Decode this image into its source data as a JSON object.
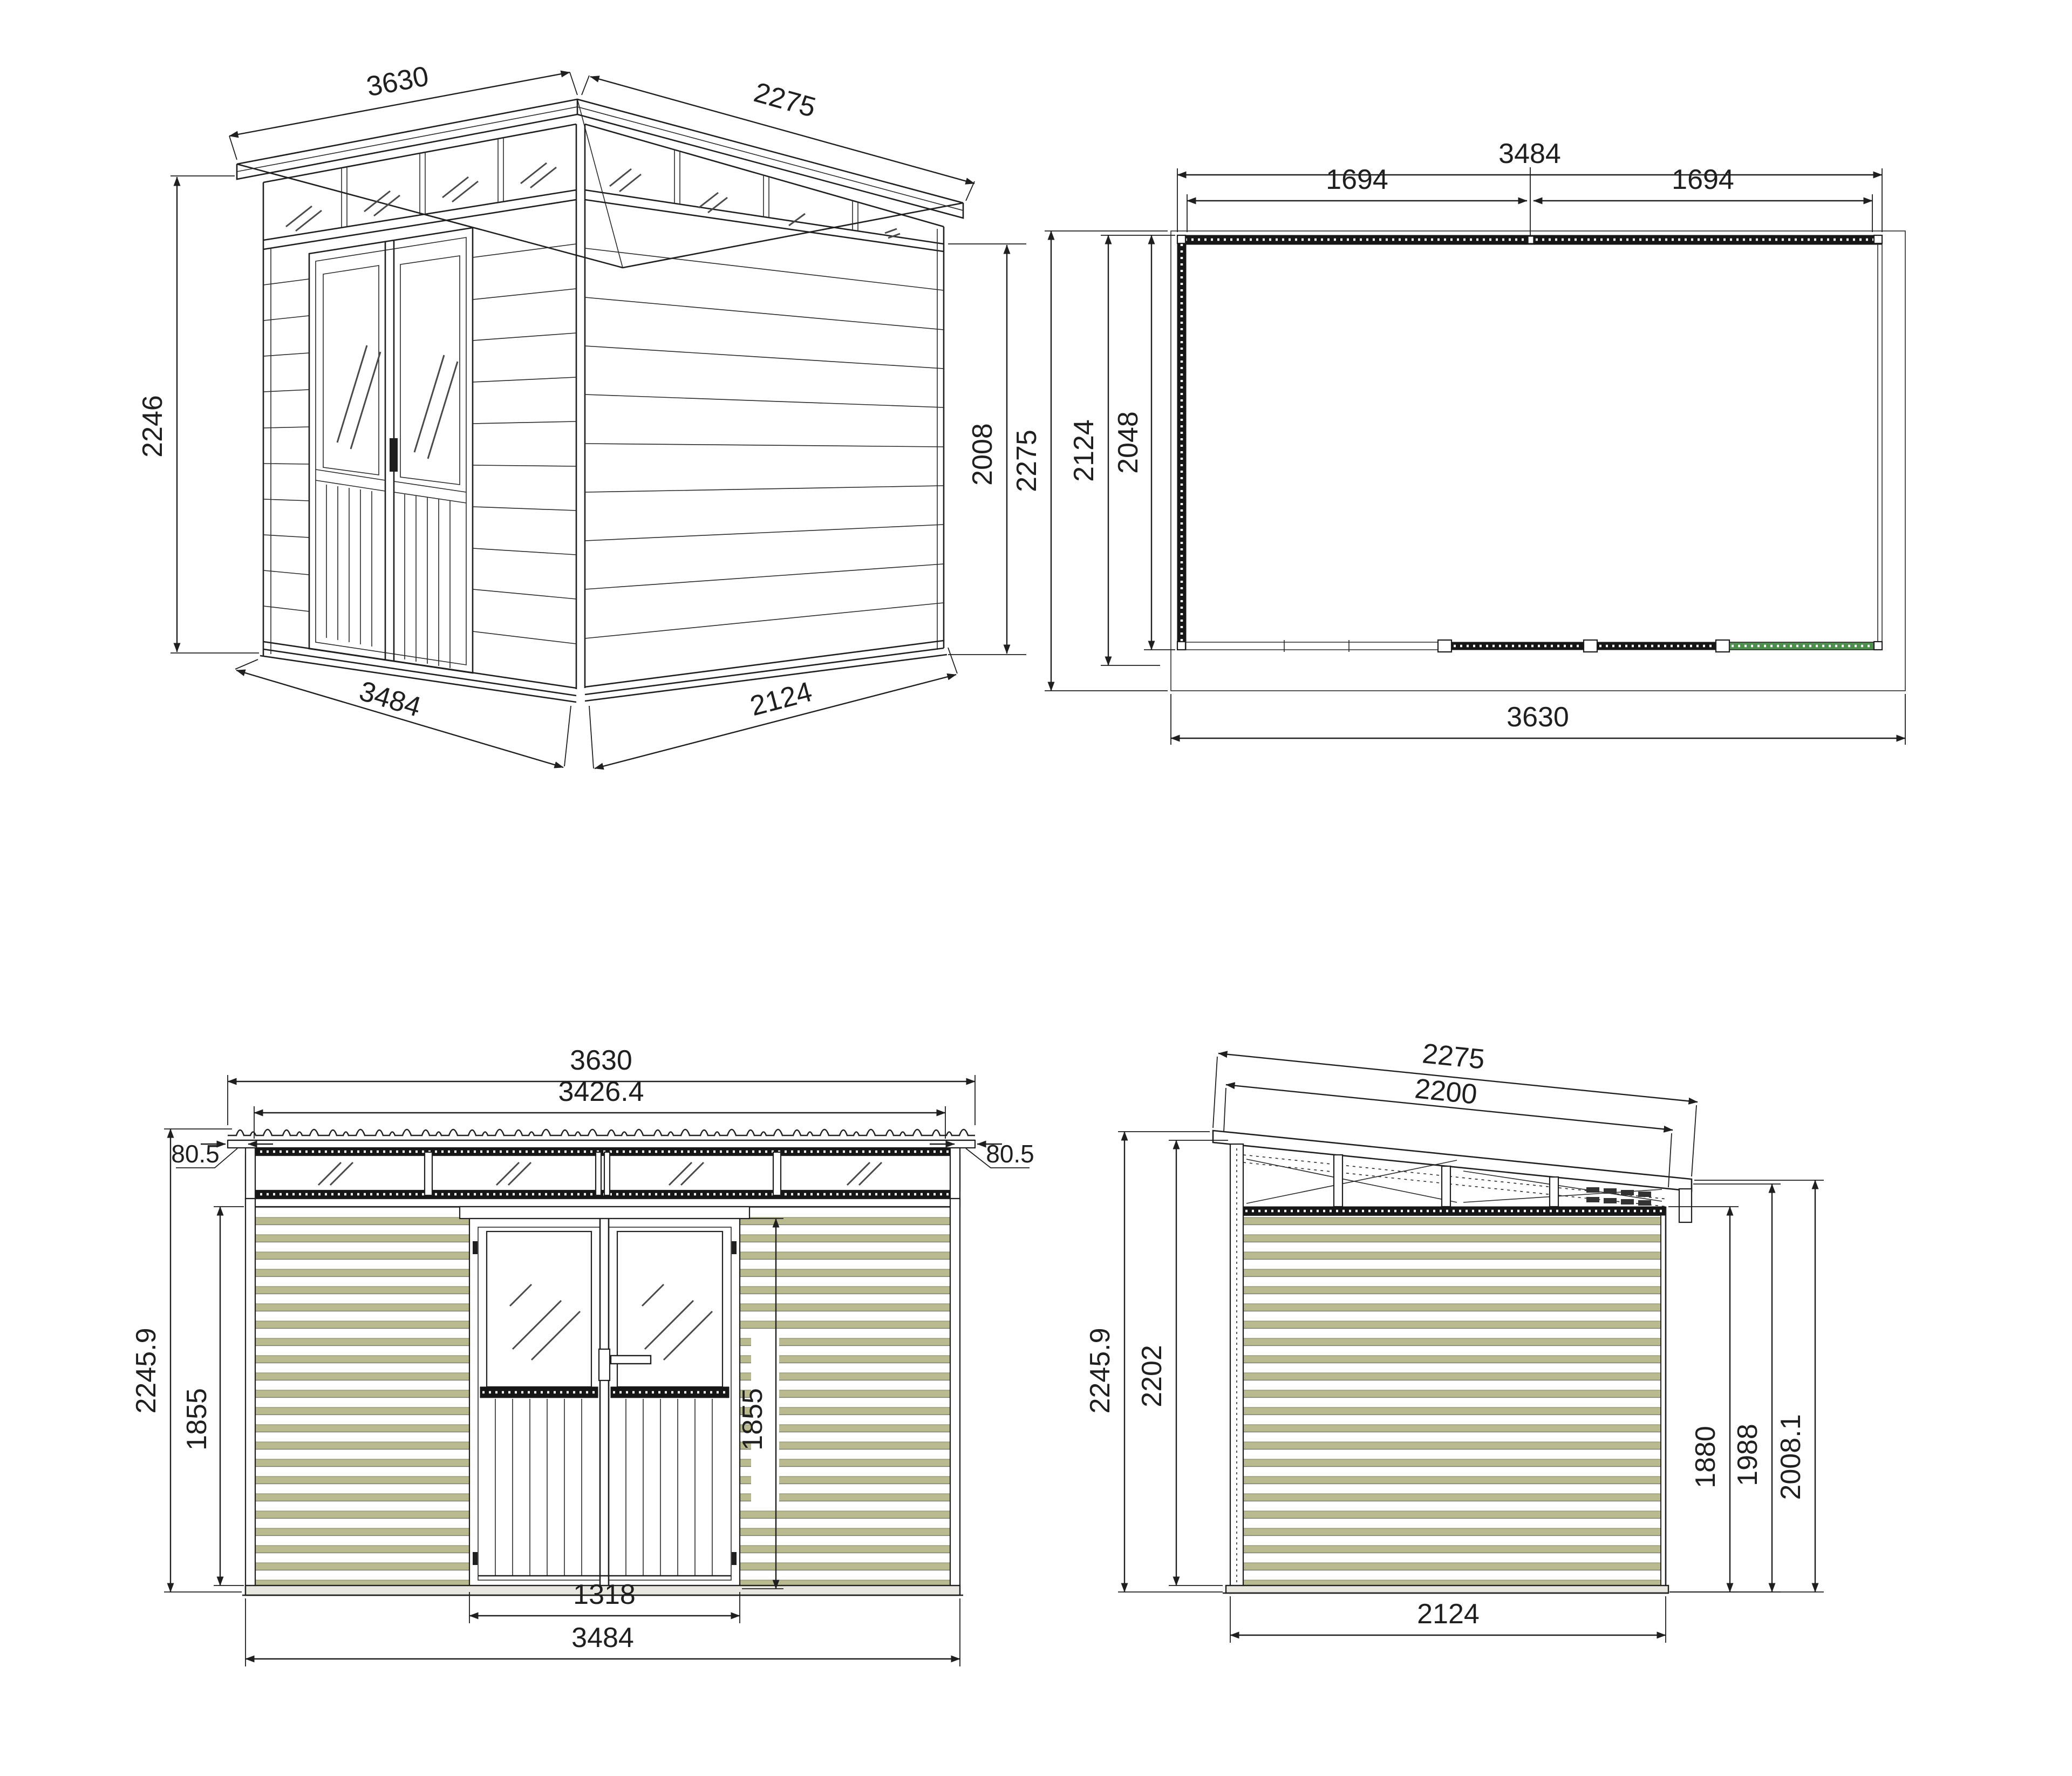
{
  "drawing_type": "shed-technical-drawing",
  "views": {
    "iso": {
      "name": "isometric-view",
      "dims": {
        "roof_front": "3630",
        "roof_side": "2275",
        "height_left": "2246",
        "height_right": "2008",
        "base_front": "3484",
        "base_side": "2124"
      }
    },
    "plan": {
      "name": "roof-plan-view",
      "dims": {
        "wall_width": "3484",
        "bay_left": "1694",
        "bay_right": "1694",
        "roof_depth": "2275",
        "floor_depth": "2124",
        "wall_depth": "2048",
        "roof_width": "3630"
      }
    },
    "front": {
      "name": "front-elevation",
      "dims": {
        "roof_width": "3630",
        "panel_width": "3426.4",
        "overhang_left": "80.5",
        "overhang_right": "80.5",
        "total_height": "2245.9",
        "wall_height_left": "1855",
        "wall_height_right": "1855",
        "door_width": "1318",
        "wall_width": "3484"
      }
    },
    "side": {
      "name": "side-elevation",
      "dims": {
        "roof_length": "2275",
        "roof_inner_length": "2200",
        "total_height": "2245.9",
        "front_height": "2202",
        "rear_wall_height": "1880",
        "eave_inner_height": "1988",
        "eave_height": "2008.1",
        "depth": "2124"
      }
    }
  },
  "colors": {
    "line": "#1f1f1f",
    "siding": "#b9ba8e",
    "base_green": "#4e8f4e",
    "background": "#ffffff"
  }
}
